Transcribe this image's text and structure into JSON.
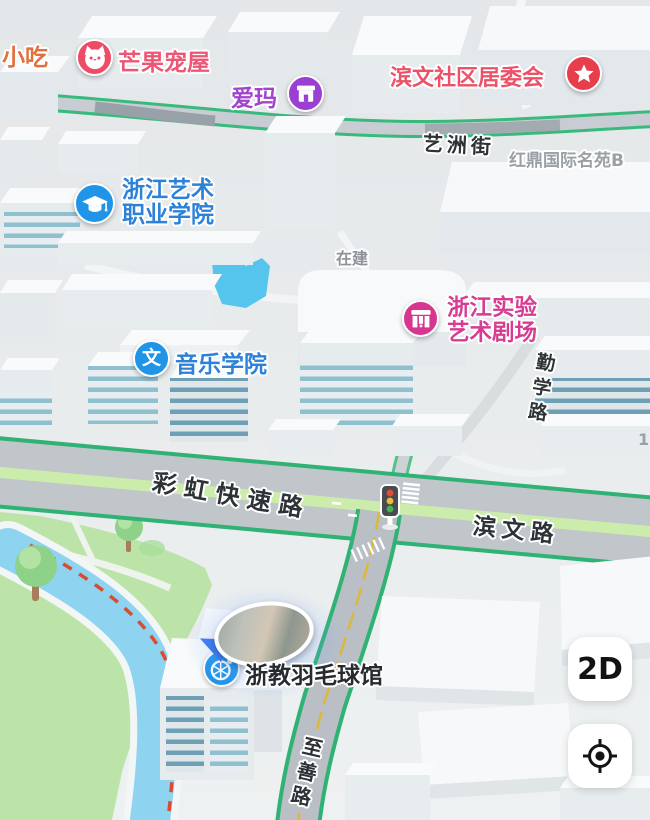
{
  "pois": {
    "xiaochi": {
      "label": "小吃",
      "color": "#e2703f"
    },
    "mangguo": {
      "label": "芒果宠屋",
      "color": "#ed5675",
      "icon": "cat-icon",
      "icon_bg": "#ee4b66"
    },
    "aima": {
      "label": "爱玛",
      "color": "#a044ce",
      "icon": "storefront-icon",
      "icon_bg": "#9b3fd2"
    },
    "juweihui": {
      "label": "滨文社区居委会",
      "color": "#ed5168",
      "icon": "star-icon",
      "icon_bg": "#e63e4a"
    },
    "hongding": {
      "label": "红鼎国际名苑B",
      "color": "#99a1a7"
    },
    "yishu_xueyuan": {
      "line1": "浙江艺术",
      "line2": "职业学院",
      "color": "#2b82d8",
      "icon": "graduation-cap-icon",
      "icon_bg": "#2095e8"
    },
    "zaijian": {
      "label": "在建",
      "color": "#8b9298"
    },
    "juchang": {
      "line1": "浙江实验",
      "line2": "艺术剧场",
      "color": "#d63d92",
      "icon": "theater-icon",
      "icon_bg": "#d6368f"
    },
    "yinyue": {
      "label": "音乐学院",
      "color": "#2b82d8",
      "icon": "wen-icon",
      "icon_bg": "#2095e8",
      "icon_char": "文"
    },
    "yumaoguan": {
      "label": "浙教羽毛球馆",
      "color": "#262b30",
      "icon": "badminton-icon",
      "icon_bg": "#2095e8"
    },
    "building_no": {
      "label": "1",
      "color": "#9aa1a7"
    }
  },
  "roads": {
    "yizhou": {
      "label": "艺洲街"
    },
    "qinxue": {
      "label": "勤学路"
    },
    "caihong": {
      "label": "彩虹快速路"
    },
    "binwen": {
      "label": "滨文路"
    },
    "zhishan": {
      "label": "至善路"
    }
  },
  "controls": {
    "view_toggle_label": "2D",
    "locate_icon": "locate-icon"
  },
  "map_colors": {
    "road_edge_green": "#2fb274",
    "median_green": "#ccecac",
    "road_gray": "#c0c6ca",
    "water_blue": "#8ed3f0",
    "pond_blue": "#55c5ee",
    "park_green": "#bce4a8",
    "congestion_dash_red": "#dc4a30",
    "traffic_light_red": "#e84a3c",
    "traffic_light_yellow": "#f3b53c",
    "traffic_light_green": "#43b355"
  }
}
